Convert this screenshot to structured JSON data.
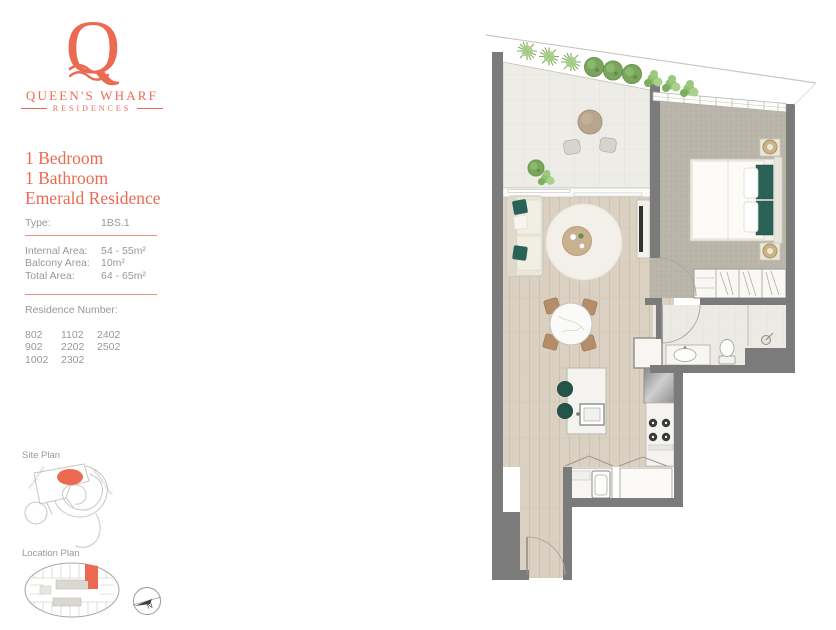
{
  "colors": {
    "accent": "#EC6A52",
    "uline": "#F09078",
    "teal": "#2B6257",
    "wall": "#7B7B7B",
    "txtgray": "#96989B",
    "wood": "#DAD0C1",
    "balcony_tile": "#EDECE6",
    "carpet": "#B9B5A9",
    "bath_tile": "#EBEAE4",
    "greenery_dark": "#79A65C",
    "greenery_light": "#A8CE87"
  },
  "logo": {
    "initial": "Q",
    "name": "QUEEN'S WHARF",
    "tagline": "RESIDENCES"
  },
  "unit": {
    "title_lines": [
      "1 Bedroom",
      "1 Bathroom",
      "Emerald Residence"
    ]
  },
  "specs": {
    "type_label": "Type:",
    "type_value": "1BS.1",
    "area_rows": [
      {
        "label": "Internal Area:",
        "value": "54 - 55m²"
      },
      {
        "label": "Balcony Area:",
        "value": "10m²"
      },
      {
        "label": "Total Area:",
        "value": "64 - 65m²"
      }
    ],
    "residence_label": "Residence Number:",
    "residence_numbers": [
      [
        "802",
        "1102",
        "2402"
      ],
      [
        "902",
        "2202",
        "2502"
      ],
      [
        "1002",
        "2302",
        ""
      ]
    ]
  },
  "site_plan": {
    "label": "Site Plan",
    "street_left": "WILLIAM STREET",
    "street_right": "MARGARET STREET"
  },
  "location_plan": {
    "label": "Location Plan"
  },
  "compass": {
    "north_label": "N"
  }
}
